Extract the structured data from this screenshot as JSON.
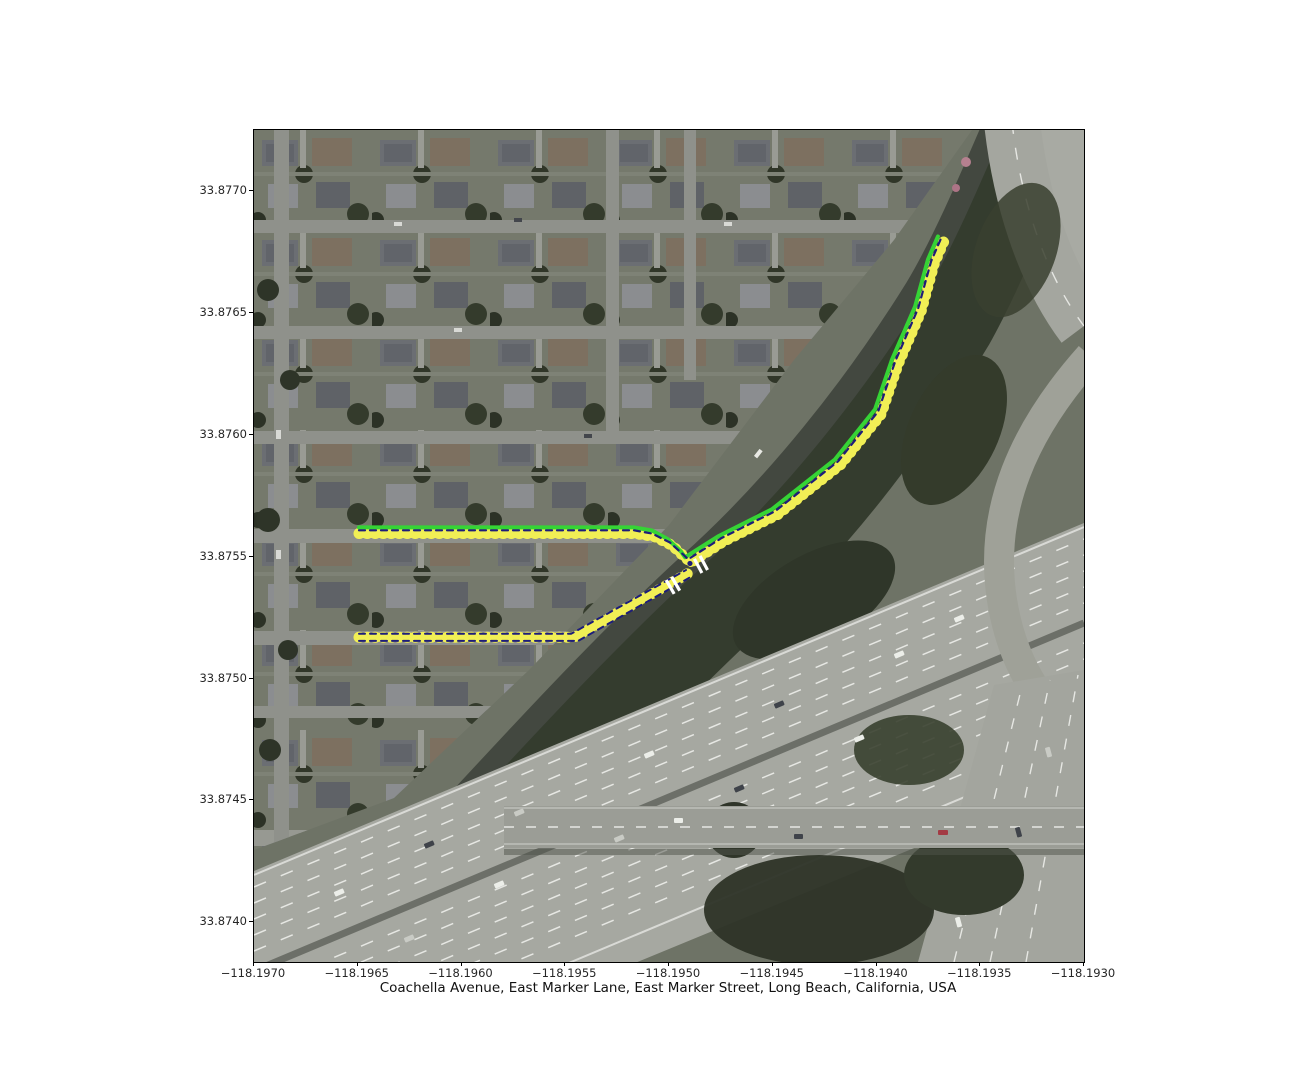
{
  "figure": {
    "caption": "Coachella Avenue, East Marker Lane, East Marker Street, Long Beach, California, USA"
  },
  "axes": {
    "x_ticks": [
      {
        "value": -118.197,
        "label": "−118.1970"
      },
      {
        "value": -118.1965,
        "label": "−118.1965"
      },
      {
        "value": -118.196,
        "label": "−118.1960"
      },
      {
        "value": -118.1955,
        "label": "−118.1955"
      },
      {
        "value": -118.195,
        "label": "−118.1950"
      },
      {
        "value": -118.1945,
        "label": "−118.1945"
      },
      {
        "value": -118.194,
        "label": "−118.1940"
      },
      {
        "value": -118.1935,
        "label": "−118.1935"
      },
      {
        "value": -118.193,
        "label": "−118.1930"
      }
    ],
    "y_ticks": [
      {
        "value": 33.877,
        "label": "33.8770"
      },
      {
        "value": 33.8765,
        "label": "33.8765"
      },
      {
        "value": 33.876,
        "label": "33.8760"
      },
      {
        "value": 33.8755,
        "label": "33.8755"
      },
      {
        "value": 33.875,
        "label": "33.8750"
      },
      {
        "value": 33.8745,
        "label": "33.8745"
      },
      {
        "value": 33.874,
        "label": "33.8740"
      }
    ]
  },
  "chart_data": {
    "type": "map",
    "title": "Coachella Avenue, East Marker Lane, East Marker Street, Long Beach, California, USA",
    "basemap": "aerial-satellite-imagery",
    "extent": {
      "lon_left": -118.197,
      "lon_right": -118.193,
      "lat_top": 33.877252,
      "lat_bottom": 33.873837
    },
    "colors": {
      "route_yellow": "#f1ef55",
      "route_green": "#35d435",
      "route_navy": "#1d1d7a",
      "marker_white": "#ffffff"
    },
    "routes": [
      {
        "name": "route-yellow-main",
        "color": "#f1ef55",
        "width": 9,
        "dash": null,
        "dot_overlay": true,
        "points": [
          [
            -118.196494,
            33.875596
          ],
          [
            -118.195169,
            33.875596
          ],
          [
            -118.195072,
            33.875584
          ],
          [
            -118.194985,
            33.875547
          ],
          [
            -118.194928,
            33.875502
          ],
          [
            -118.194894,
            33.875477
          ],
          [
            -118.194735,
            33.875564
          ],
          [
            -118.194475,
            33.875674
          ],
          [
            -118.194171,
            33.87588
          ],
          [
            -118.193978,
            33.876085
          ],
          [
            -118.193896,
            33.87629
          ],
          [
            -118.193785,
            33.876508
          ],
          [
            -118.193723,
            33.8767
          ],
          [
            -118.193675,
            33.876795
          ]
        ]
      },
      {
        "name": "route-yellow-south",
        "color": "#f1ef55",
        "width": 9,
        "dash": null,
        "dot_overlay": true,
        "points": [
          [
            -118.196494,
            33.87517
          ],
          [
            -118.195482,
            33.87517
          ],
          [
            -118.195448,
            33.875174
          ],
          [
            -118.194908,
            33.875432
          ]
        ]
      },
      {
        "name": "route-green",
        "color": "#35d435",
        "width": 4,
        "dash": null,
        "dot_overlay": false,
        "points": [
          [
            -118.196494,
            33.875621
          ],
          [
            -118.195169,
            33.875621
          ],
          [
            -118.195082,
            33.875608
          ],
          [
            -118.195005,
            33.875572
          ],
          [
            -118.194942,
            33.875522
          ],
          [
            -118.194923,
            33.875498
          ],
          [
            -118.194764,
            33.875584
          ],
          [
            -118.194504,
            33.875695
          ],
          [
            -118.1942,
            33.8759
          ],
          [
            -118.194007,
            33.876105
          ],
          [
            -118.193925,
            33.876311
          ],
          [
            -118.193814,
            33.876528
          ],
          [
            -118.193752,
            33.876721
          ],
          [
            -118.193704,
            33.876815
          ]
        ]
      },
      {
        "name": "route-navy-main-center",
        "color": "#1d1d7a",
        "width": 2.2,
        "dash": "6 5",
        "dot_overlay": false,
        "points": [
          [
            -118.196494,
            33.875609
          ],
          [
            -118.195169,
            33.875609
          ],
          [
            -118.195082,
            33.875596
          ],
          [
            -118.194995,
            33.875559
          ],
          [
            -118.194932,
            33.87551
          ],
          [
            -118.194908,
            33.87549
          ],
          [
            -118.194749,
            33.875576
          ],
          [
            -118.194489,
            33.875687
          ],
          [
            -118.194185,
            33.875892
          ],
          [
            -118.193992,
            33.876097
          ],
          [
            -118.19391,
            33.876302
          ],
          [
            -118.193799,
            33.87652
          ],
          [
            -118.193737,
            33.876713
          ],
          [
            -118.193689,
            33.876807
          ]
        ]
      },
      {
        "name": "route-navy-south-north-edge",
        "color": "#1d1d7a",
        "width": 2,
        "dash": "6 5",
        "dot_overlay": false,
        "points": [
          [
            -118.196494,
            33.875184
          ],
          [
            -118.195472,
            33.875184
          ],
          [
            -118.194918,
            33.875446
          ]
        ]
      },
      {
        "name": "route-navy-south-south-edge",
        "color": "#1d1d7a",
        "width": 2,
        "dash": "6 5",
        "dot_overlay": false,
        "points": [
          [
            -118.196494,
            33.875155
          ],
          [
            -118.195438,
            33.875155
          ],
          [
            -118.194894,
            33.875418
          ]
        ]
      }
    ],
    "junction_markers": [
      {
        "lon": -118.194981,
        "lat": 33.875383,
        "bar_angle_deg": 60
      },
      {
        "lon": -118.194846,
        "lat": 33.875469,
        "bar_angle_deg": 62
      }
    ],
    "node_dots": [
      {
        "lon": -118.194899,
        "lat": 33.875473
      }
    ]
  }
}
